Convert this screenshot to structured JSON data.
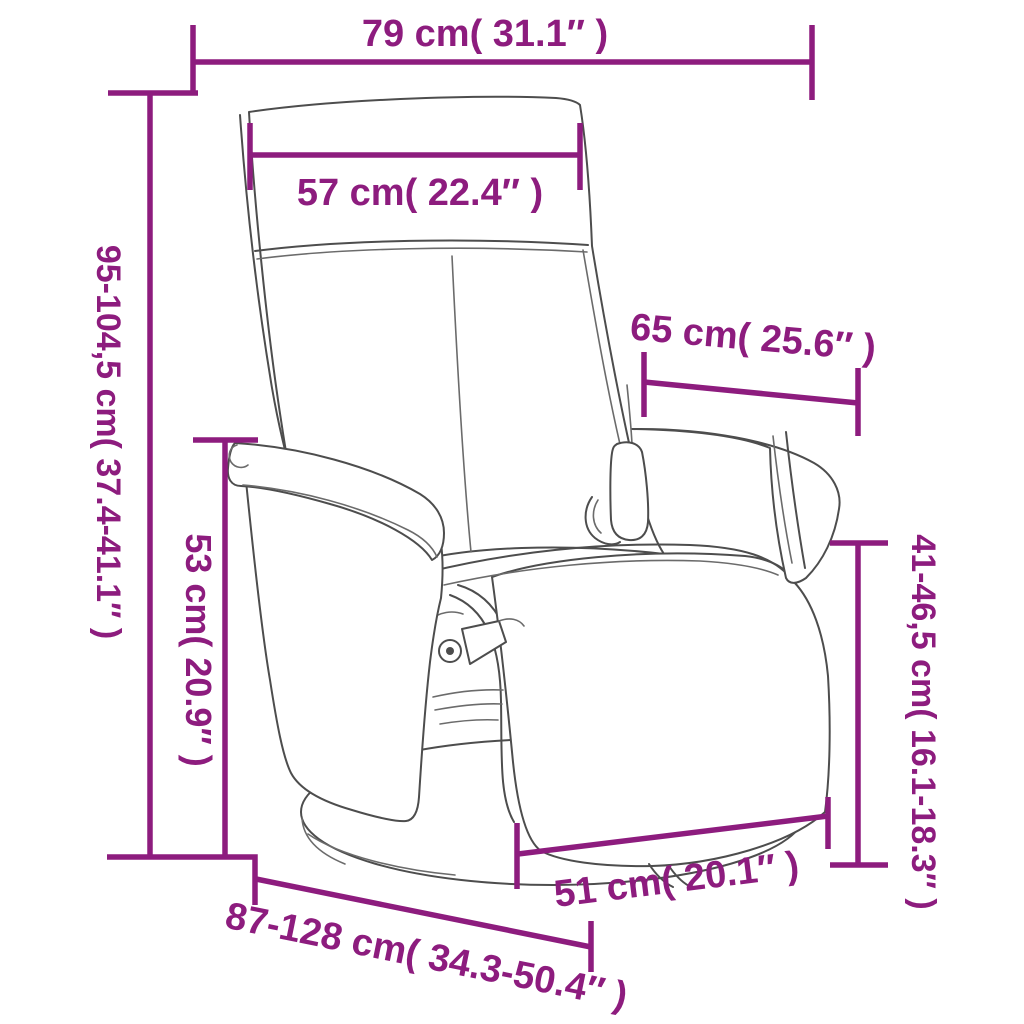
{
  "figure": {
    "type": "product-dimension-diagram",
    "subject": "swivel recliner massage chair with footrest and round base",
    "style": "line drawing with measurement annotations"
  },
  "colors": {
    "dimension_annotation": "#8d1c7e",
    "line_art": "#4d4d4d",
    "background": "#ffffff"
  },
  "dimensions": [
    {
      "id": "total-width",
      "label": "79 cm( 31.1″ )",
      "orientation": "horizontal-top"
    },
    {
      "id": "headrest-width",
      "label": "57 cm( 22.4″ )",
      "orientation": "horizontal"
    },
    {
      "id": "total-height",
      "label": "95-104,5 cm( 37.4-41.1″ )",
      "orientation": "vertical-left"
    },
    {
      "id": "armrest-height",
      "label": "53 cm( 20.9″ )",
      "orientation": "vertical-left-inner"
    },
    {
      "id": "seat-depth",
      "label": "65 cm( 25.6″ )",
      "orientation": "horizontal-right"
    },
    {
      "id": "seat-height",
      "label": "41-46,5 cm( 16.1-18.3″ )",
      "orientation": "vertical-right"
    },
    {
      "id": "base-width",
      "label": "51 cm( 20.1″ )",
      "orientation": "diagonal-bottom"
    },
    {
      "id": "recline-length",
      "label": "87-128 cm( 34.3-50.4″ )",
      "orientation": "diagonal-bottom-left"
    }
  ]
}
